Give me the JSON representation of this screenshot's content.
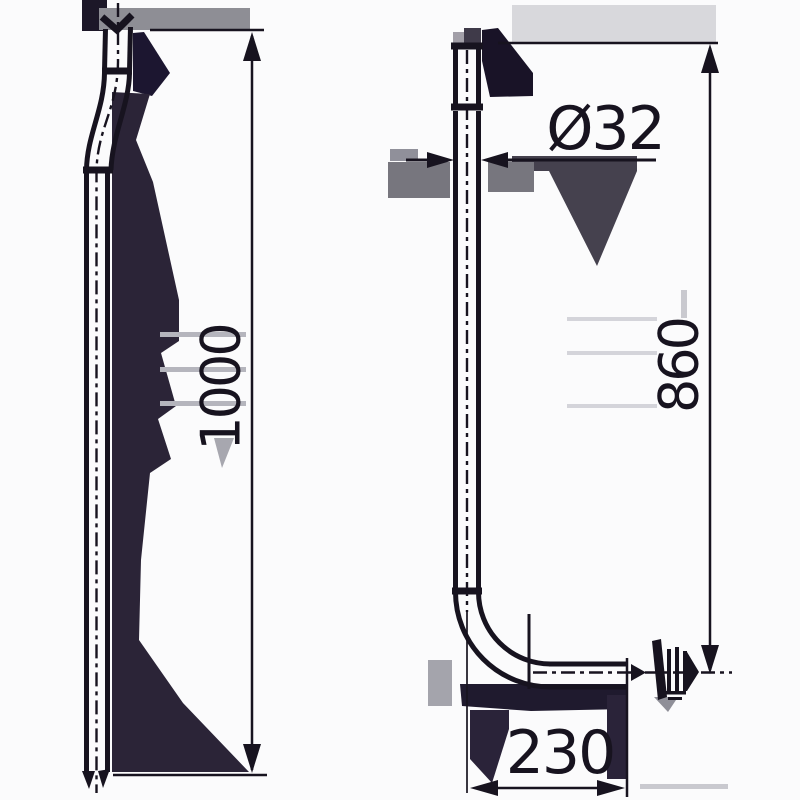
{
  "title": "flush-pipe-technical-drawing",
  "colors": {
    "line": "#17131f",
    "background": "#fbfbfc",
    "artifact_dark": "#2b2437",
    "artifact_gray": "#d8d8dc"
  },
  "views": {
    "side_view_position": "left",
    "front_view_position": "right"
  },
  "dimensions": {
    "total_length": "1000",
    "diameter": "Ø32",
    "inlet_to_outlet_height": "860",
    "outlet_offset": "230"
  }
}
